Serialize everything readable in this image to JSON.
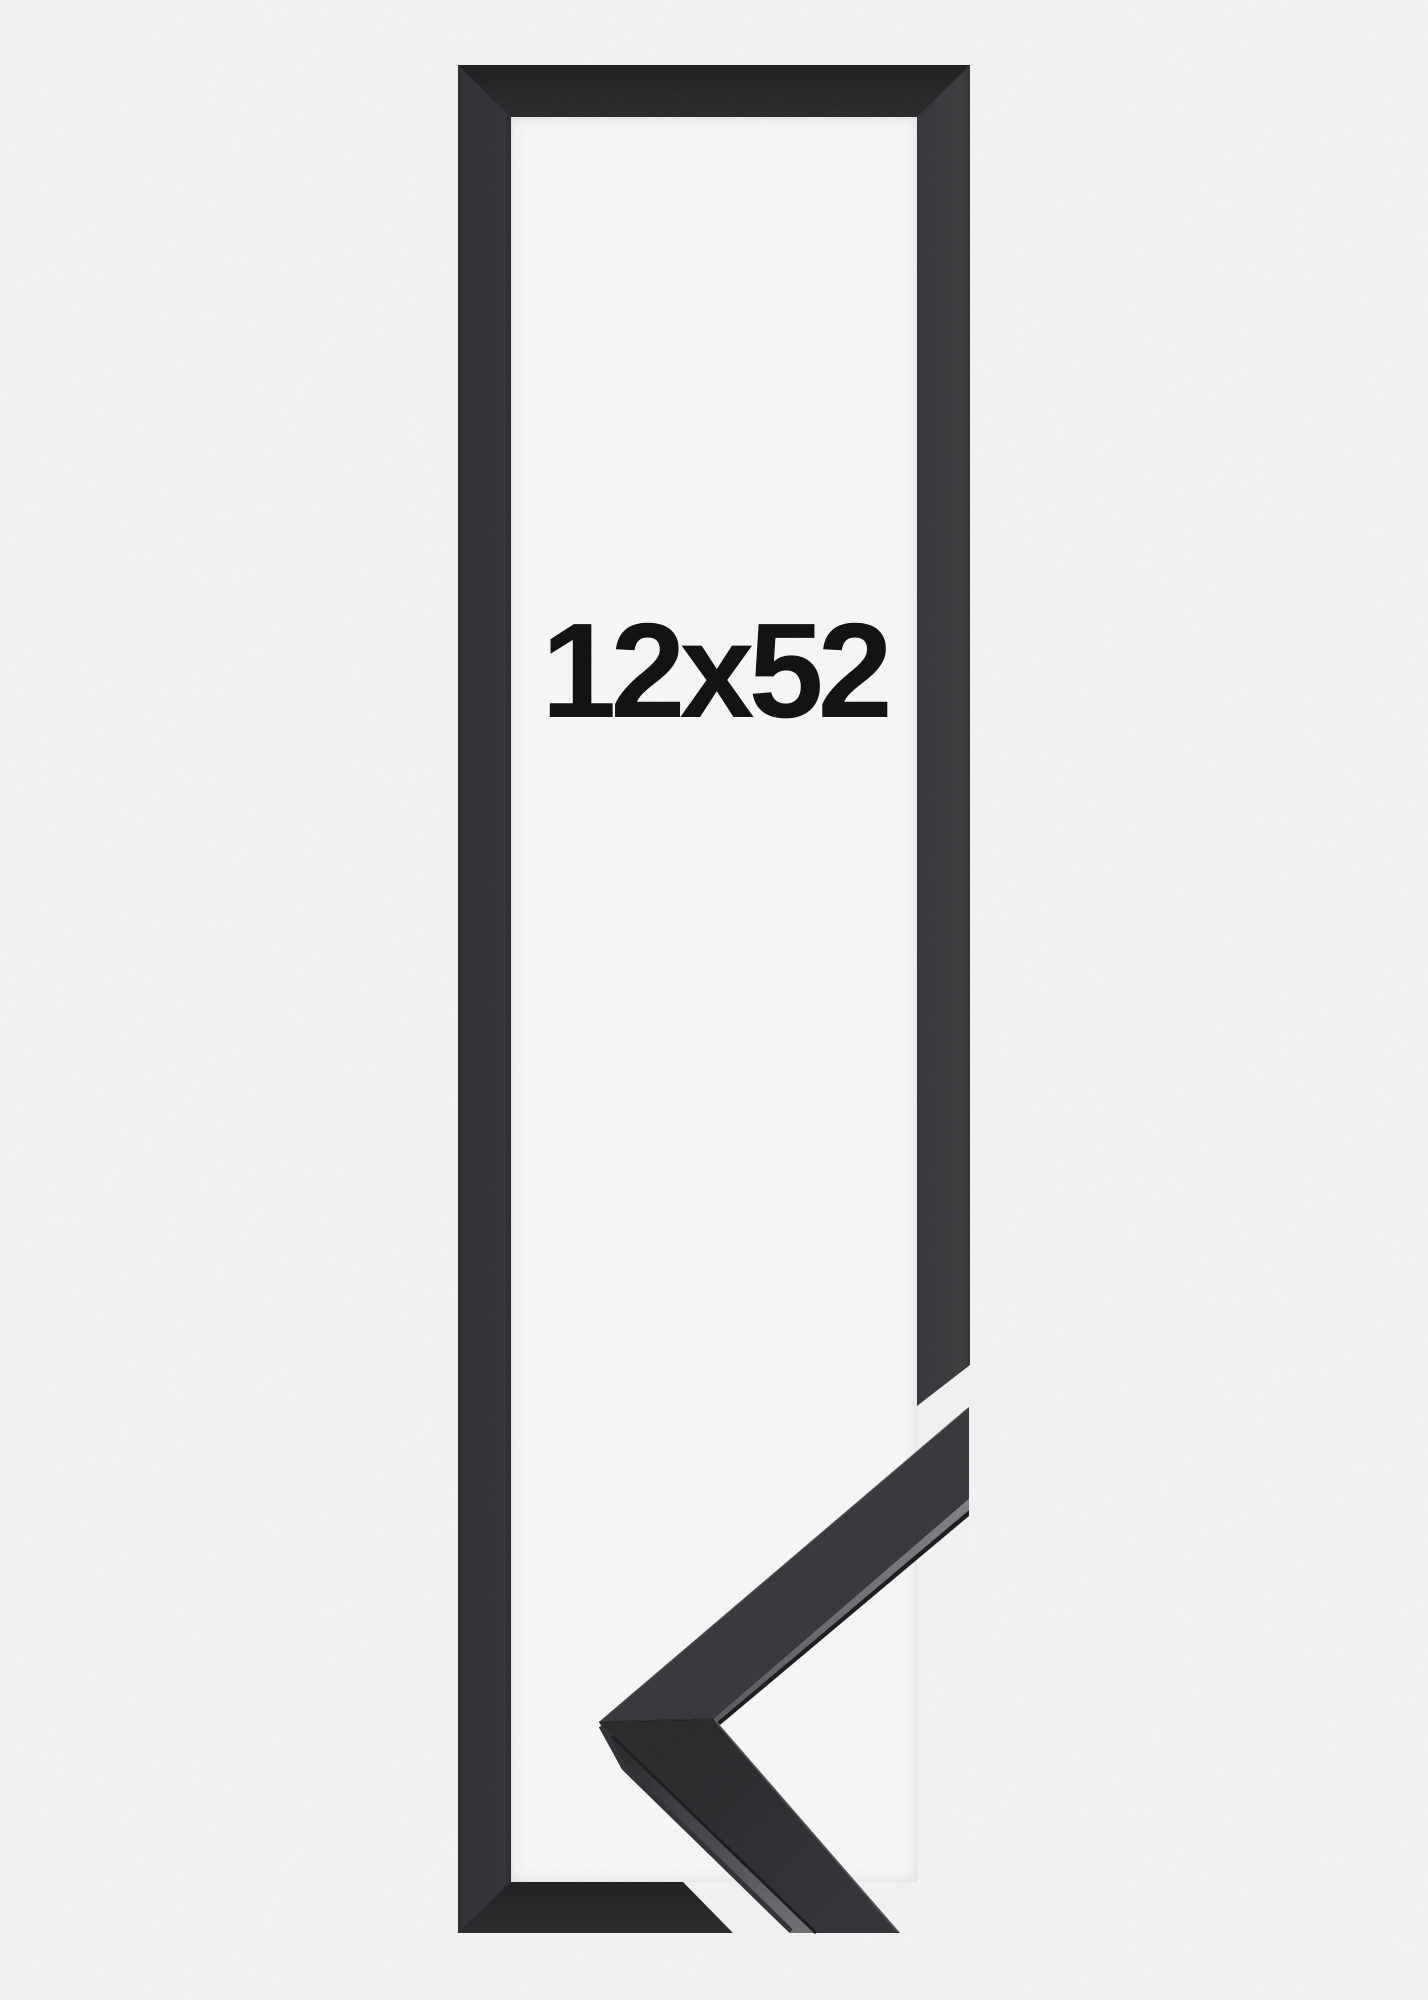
{
  "product_image": {
    "size_label": "12x52",
    "colors": {
      "background": "#f1f1f2",
      "inner_opening": "#f5f6f6",
      "frame_black": "#2e2f31",
      "sample_side_face_gray": "#6b6d70",
      "label_text": "#121314"
    }
  }
}
